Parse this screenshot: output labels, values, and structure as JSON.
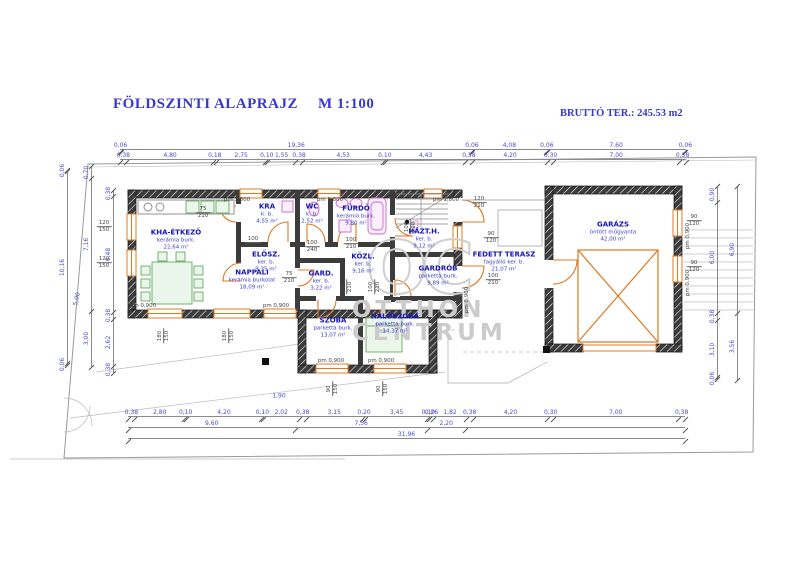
{
  "header": {
    "title": "FÖLDSZINTI ALAPRAJZ",
    "scale": "M 1:100",
    "gross_area_label": "BRUTTÓ TER.: 245.53 m2"
  },
  "watermark": {
    "monogram": "OC",
    "line1": "OTTHON",
    "line2": "CENTRUM"
  },
  "colors": {
    "accent_blue": "#3838cc",
    "dim_blue": "#4a4ad0",
    "orange": "#e07820",
    "wall_dark": "#3c3c3c",
    "watermark_gray": "#cbcbcb",
    "boundary_gray": "#999999",
    "furniture_green": "#66aa66",
    "fixture_magenta": "#cc66cc"
  },
  "rooms": [
    {
      "id": "kha-etkezo",
      "name": "KHA-ÉTKEZŐ",
      "finish": "kerámia burk.",
      "area": "22,64 m²",
      "x": 176,
      "y": 240
    },
    {
      "id": "nappali",
      "name": "NAPPALI",
      "finish": "kerámia burkolat",
      "area": "18,09 m²",
      "x": 252,
      "y": 280
    },
    {
      "id": "kra",
      "name": "KRA",
      "finish": "k. b.",
      "area": "4,55 m²",
      "x": 267,
      "y": 214
    },
    {
      "id": "wc",
      "name": "WC",
      "finish": "k. b.",
      "area": "2,52 m²",
      "x": 312,
      "y": 214
    },
    {
      "id": "elosz",
      "name": "ELŐSZ.",
      "finish": "ker. b.",
      "area": "9,35 m²",
      "x": 266,
      "y": 262
    },
    {
      "id": "furdo",
      "name": "FÜRDŐ",
      "finish": "kerámia burk.",
      "area": "9,80 m²",
      "x": 356,
      "y": 216
    },
    {
      "id": "kozl",
      "name": "KÖZL.",
      "finish": "ker. b.",
      "area": "9,16 m²",
      "x": 363,
      "y": 264
    },
    {
      "id": "gard",
      "name": "GARD.",
      "finish": "ker. b.",
      "area": "3,22 m²",
      "x": 321,
      "y": 281
    },
    {
      "id": "hazth",
      "name": "HÁZT.H.",
      "finish": "ker. b.",
      "area": "9,12 m²",
      "x": 424,
      "y": 239
    },
    {
      "id": "gardrob",
      "name": "GARDRÓB",
      "finish": "parketta burk.",
      "area": "9,89 m²",
      "x": 438,
      "y": 276
    },
    {
      "id": "szoba",
      "name": "SZOBA",
      "finish": "parketta burk.",
      "area": "13,07 m²",
      "x": 333,
      "y": 328
    },
    {
      "id": "haloszoba",
      "name": "HÁLÓSZOBA",
      "finish": "parketta burk.",
      "area": "14,37 m²",
      "x": 395,
      "y": 324
    },
    {
      "id": "fedett-terasz",
      "name": "FEDETT TERASZ",
      "finish": "fagyálló ker. b.",
      "area": "21,07 m²",
      "x": 504,
      "y": 262
    },
    {
      "id": "garazs",
      "name": "GARÁZS",
      "finish": "öntött műgyanta",
      "area": "42,00 m²",
      "x": 613,
      "y": 232
    }
  ],
  "dim_rows": [
    {
      "dir": "h",
      "x": 120,
      "y": 140,
      "len": 566,
      "values": [
        "0,06",
        "19,36",
        "0,06",
        "4,08",
        "0,06",
        "7,60",
        "0,06"
      ]
    },
    {
      "dir": "h",
      "x": 120,
      "y": 150,
      "len": 566,
      "values": [
        "0,38",
        "4,80",
        "0,18",
        "2,75",
        "0,10",
        "1,55",
        "0,38",
        "4,53",
        "0,10",
        "4,43",
        "0,38",
        "4,20",
        "0,30",
        "7,00",
        "0,38"
      ]
    },
    {
      "dir": "h",
      "x": 128,
      "y": 407,
      "len": 557,
      "values": [
        "0,38",
        "2,80",
        "0,10",
        "4,20",
        "0,10",
        "2,02",
        "0,38",
        "3,15",
        "0,20",
        "3,45",
        "0,10",
        "0,26",
        "1,82",
        "0,38",
        "4,20",
        "0,30",
        "7,00",
        "0,38"
      ]
    },
    {
      "dir": "h",
      "x": 128,
      "y": 418,
      "len": 557,
      "values": [
        "9,60",
        "7,56",
        "2,20",
        ""
      ],
      "weights": [
        9.6,
        7.56,
        2.2,
        12.6
      ]
    },
    {
      "dir": "h",
      "x": 128,
      "y": 429,
      "len": 557,
      "values": [
        "31,96"
      ]
    },
    {
      "dir": "v",
      "x": 58,
      "y": 170,
      "len": 195,
      "values": [
        "0,06",
        "10,16",
        "0,06"
      ]
    },
    {
      "dir": "v",
      "x": 82,
      "y": 166,
      "len": 201,
      "values": [
        "0,70",
        "7,16",
        "3,00"
      ]
    },
    {
      "dir": "v",
      "x": 104,
      "y": 190,
      "len": 183,
      "values": [
        "0,38",
        "6,48",
        "0,38",
        "2,62",
        "0,38"
      ]
    },
    {
      "dir": "v",
      "x": 708,
      "y": 186,
      "len": 193,
      "values": [
        "0,90",
        "6,00",
        "0,38",
        "3,10",
        "0,06"
      ]
    },
    {
      "dir": "v",
      "x": 728,
      "y": 186,
      "len": 194,
      "values": [
        "6,90",
        "3,56"
      ]
    }
  ],
  "openings": [
    {
      "top": "100",
      "bottom": "240",
      "x": 253,
      "y": 243,
      "v": false
    },
    {
      "top": "100",
      "bottom": "240",
      "x": 312,
      "y": 247,
      "v": false
    },
    {
      "top": "75",
      "bottom": "210",
      "x": 203,
      "y": 213,
      "v": false
    },
    {
      "top": "75",
      "bottom": "210",
      "x": 289,
      "y": 278,
      "v": false
    },
    {
      "top": "100",
      "bottom": "210",
      "x": 351,
      "y": 244,
      "v": false
    },
    {
      "top": "100",
      "bottom": "210",
      "x": 347,
      "y": 287,
      "v": true
    },
    {
      "top": "100",
      "bottom": "210",
      "x": 375,
      "y": 287,
      "v": true
    },
    {
      "top": "100",
      "bottom": "210",
      "x": 411,
      "y": 227,
      "v": true
    },
    {
      "top": "90",
      "bottom": "150",
      "x": 333,
      "y": 389,
      "v": true
    },
    {
      "top": "90",
      "bottom": "150",
      "x": 383,
      "y": 389,
      "v": true
    },
    {
      "top": "180",
      "bottom": "150",
      "x": 164,
      "y": 336,
      "v": true
    },
    {
      "top": "180",
      "bottom": "150",
      "x": 229,
      "y": 336,
      "v": true
    },
    {
      "top": "120",
      "bottom": "150",
      "x": 104,
      "y": 227,
      "v": false
    },
    {
      "top": "120",
      "bottom": "150",
      "x": 104,
      "y": 263,
      "v": false
    },
    {
      "top": "90",
      "bottom": "120",
      "x": 694,
      "y": 221,
      "v": false
    },
    {
      "top": "90",
      "bottom": "120",
      "x": 694,
      "y": 267,
      "v": false
    },
    {
      "top": "120",
      "bottom": "210",
      "x": 479,
      "y": 203,
      "v": false
    },
    {
      "top": "90",
      "bottom": "120",
      "x": 491,
      "y": 238,
      "v": false
    },
    {
      "top": "100",
      "bottom": "210",
      "x": 493,
      "y": 280,
      "v": false
    }
  ],
  "annotations": [
    {
      "text": "pm 1,800",
      "x": 237,
      "y": 200,
      "v": false
    },
    {
      "text": "pm 1,800",
      "x": 330,
      "y": 200,
      "v": false
    },
    {
      "text": "pm 1,800",
      "x": 446,
      "y": 200,
      "v": false
    },
    {
      "text": "pm 0,900",
      "x": 143,
      "y": 306,
      "v": false
    },
    {
      "text": "pm 0,900",
      "x": 276,
      "y": 306,
      "v": false
    },
    {
      "text": "pm 0,900",
      "x": 331,
      "y": 361,
      "v": false
    },
    {
      "text": "pm 0,900",
      "x": 381,
      "y": 361,
      "v": false
    },
    {
      "text": "pm 0,900",
      "x": 467,
      "y": 300,
      "v": true
    },
    {
      "text": "pm 0,900",
      "x": 688,
      "y": 236,
      "v": true
    },
    {
      "text": "pm 0,900",
      "x": 688,
      "y": 283,
      "v": true
    }
  ],
  "small_dims": [
    {
      "text": "1,90",
      "x": 279,
      "y": 396,
      "rot": false
    },
    {
      "text": "5,00",
      "x": 77,
      "y": 299,
      "rot": true
    }
  ]
}
